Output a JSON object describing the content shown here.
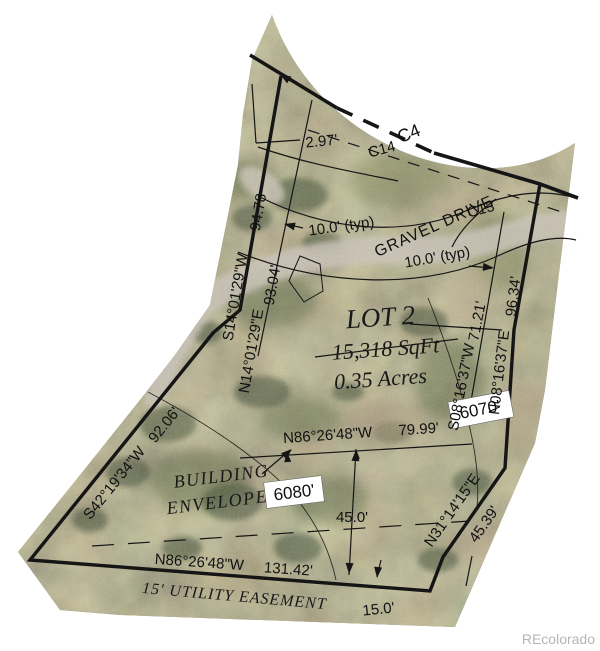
{
  "survey": {
    "lot": {
      "name": "LOT 2",
      "sqft": "15,318 SqFt",
      "acres": "0.35 Acres"
    },
    "road": {
      "gravel_drive": "GRAVEL DRIVE",
      "curve_c4": "C4",
      "curve_c14": "C14",
      "curve_c13": "C13",
      "width_typ_left": "10.0' (typ)",
      "width_typ_right": "10.0' (typ)",
      "offset_297": "2.97'"
    },
    "bearings": {
      "s14": {
        "dir": "S14°01'29\"W",
        "len": "94.78"
      },
      "n14": {
        "dir": "N14°01'29\"E",
        "len": "93.04'"
      },
      "n08": {
        "dir": "N08°16'37\"E",
        "len": "96.34'"
      },
      "s08": {
        "dir": "S08°16'37\"W",
        "len": "71.21'"
      },
      "s42": {
        "dir": "S42°19'34\"W",
        "len": "92.06'"
      },
      "n31": {
        "dir": "N31°14'15\"E",
        "len": "45.39'"
      },
      "n86_mid": {
        "dir": "N86°26'48\"W",
        "len": "79.99'"
      },
      "n86_bottom": {
        "dir": "N86°26'48\"W",
        "len": "131.42'"
      }
    },
    "dims": {
      "envelope_depth": "45.0'",
      "easement_width": "15.0'"
    },
    "envelope": {
      "line1": "BUILDING",
      "line2": "ENVELOPE"
    },
    "easement_label": "15' UTILITY EASEMENT",
    "elevations": {
      "upper": "6080'",
      "lower": "6070'"
    }
  },
  "watermark": {
    "text": "REcolorado"
  },
  "colors": {
    "line": "#151515",
    "terrain_base": "#8d8767",
    "gravel": "#ccc5b9",
    "elevation_box_bg": "#ffffff",
    "watermark": "#b5b5b5"
  }
}
